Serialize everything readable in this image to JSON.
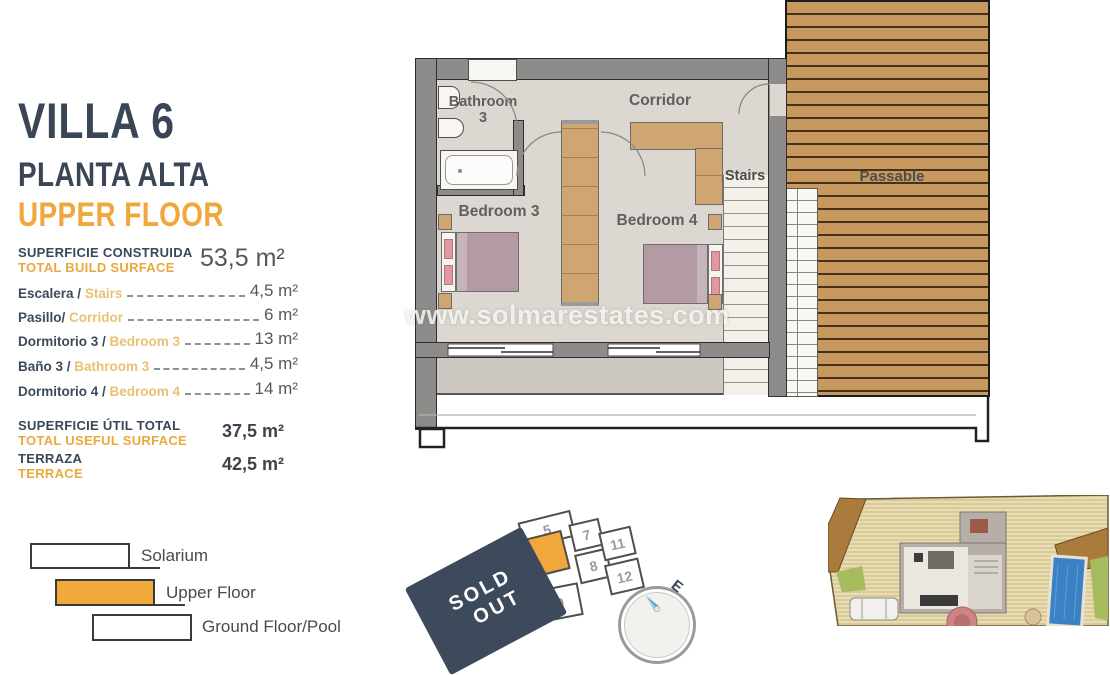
{
  "panel": {
    "title": "VILLA 6",
    "subtitle_es": "PLANTA ALTA",
    "subtitle_en": "UPPER FLOOR",
    "build_surface": {
      "label_es": "SUPERFICIE CONSTRUIDA",
      "label_en": "TOTAL BUILD SURFACE",
      "value": "53,5 m²"
    },
    "rooms": [
      {
        "es": "Escalera / ",
        "en": "Stairs",
        "value": "4,5 m²"
      },
      {
        "es": "Pasillo/ ",
        "en": "Corridor",
        "value": "6 m²"
      },
      {
        "es": "Dormitorio 3 / ",
        "en": "Bedroom 3",
        "value": "13 m²"
      },
      {
        "es": "Baño 3 / ",
        "en": "Bathroom 3",
        "value": "4,5 m²"
      },
      {
        "es": "Dormitorio 4 / ",
        "en": "Bedroom 4",
        "value": "14 m²"
      }
    ],
    "useful": {
      "label_es": "SUPERFICIE ÚTIL TOTAL",
      "label_en": "TOTAL USEFUL SURFACE",
      "value": "37,5 m²"
    },
    "terrace": {
      "label_es": "TERRAZA",
      "label_en": "TERRACE",
      "value": "42,5 m²"
    }
  },
  "legend": {
    "items": [
      {
        "label": "Solarium"
      },
      {
        "label": "Upper Floor"
      },
      {
        "label": "Ground Floor/Pool"
      }
    ]
  },
  "floorplan": {
    "labels": {
      "bathroom_line1": "Bathroom",
      "bathroom_line2": "3",
      "corridor": "Corridor",
      "bedroom3": "Bedroom 3",
      "bedroom4": "Bedroom 4",
      "stairs": "Stairs",
      "passable": "Passable"
    },
    "watermark": "www.solmarestates.com"
  },
  "plot_map": {
    "cells": {
      "c5": "5",
      "c6": "6",
      "c7": "7",
      "c8": "8",
      "c9": "9",
      "c11": "11",
      "c12": "12"
    },
    "highlighted_cell": "6",
    "sold_out_line1": "SOLD",
    "sold_out_line2": "OUT",
    "compass_label": "E"
  },
  "colors": {
    "accent_orange": "#f0a73c",
    "navy": "#3a4656",
    "secondary_orange": "#e9c173",
    "sold_out_navy": "#3d4a5c",
    "deck_wood": "#c8995e",
    "pool_blue": "#3b82c4"
  }
}
